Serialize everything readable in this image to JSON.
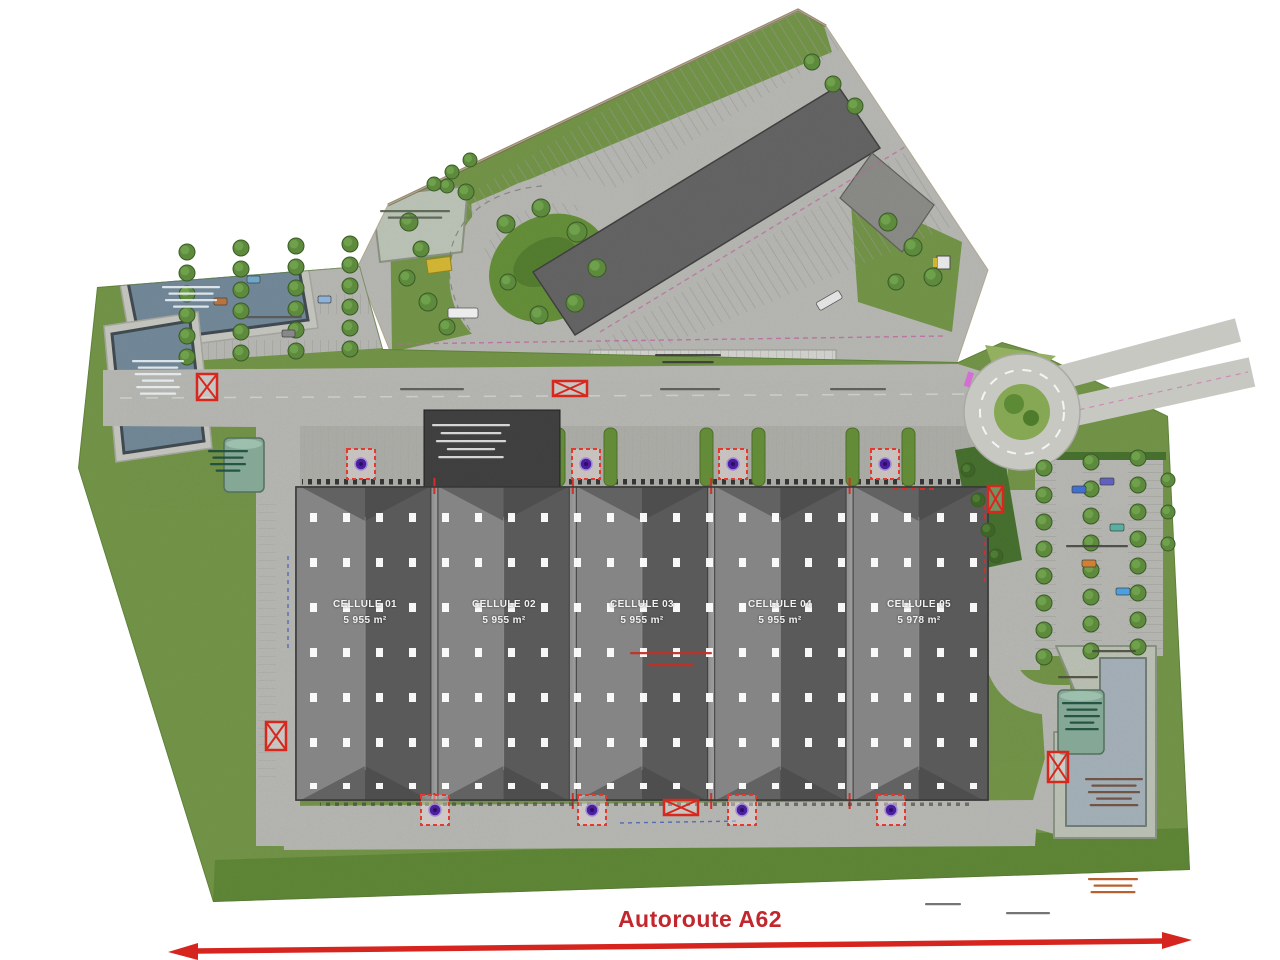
{
  "plan": {
    "title_hint": "Autoroute A62",
    "building": {
      "cells": [
        {
          "name": "CELLULE 01",
          "area": "5 955 m²"
        },
        {
          "name": "CELLULE 02",
          "area": "5 955 m²"
        },
        {
          "name": "CELLULE 03",
          "area": "5 955 m²"
        },
        {
          "name": "CELLULE 04",
          "area": "5 955 m²"
        },
        {
          "name": "CELLULE 05",
          "area": "5 978 m²"
        }
      ]
    },
    "road": {
      "label": "Autoroute A62"
    }
  },
  "icons": {
    "gate_marker": "red-crossed-rectangle",
    "sprinkler_marker": "red-dashed-square-with-purple-dot",
    "roundabout": "circle-with-green-island",
    "retention_basin": "blue-water-polygon",
    "tree": "green-circle"
  },
  "colors": {
    "accent_red": "#c1272d",
    "marker_red": "#d8281e",
    "dot_purple": "#4b1e9e",
    "grass": "#7da24f",
    "grass_dark": "#649138",
    "road": "#c8c8c3",
    "road_dark": "#bdbdb8",
    "building_light": "#858585",
    "building_dark": "#5a5a5a",
    "existing_building": "#6e6e6e",
    "basin_water": "#7d95a6",
    "basin_water_light": "#b4c1ca",
    "tree_green": "#5d8a3d",
    "hedge_green": "#3f6428",
    "tank_teal": "#84a895"
  }
}
